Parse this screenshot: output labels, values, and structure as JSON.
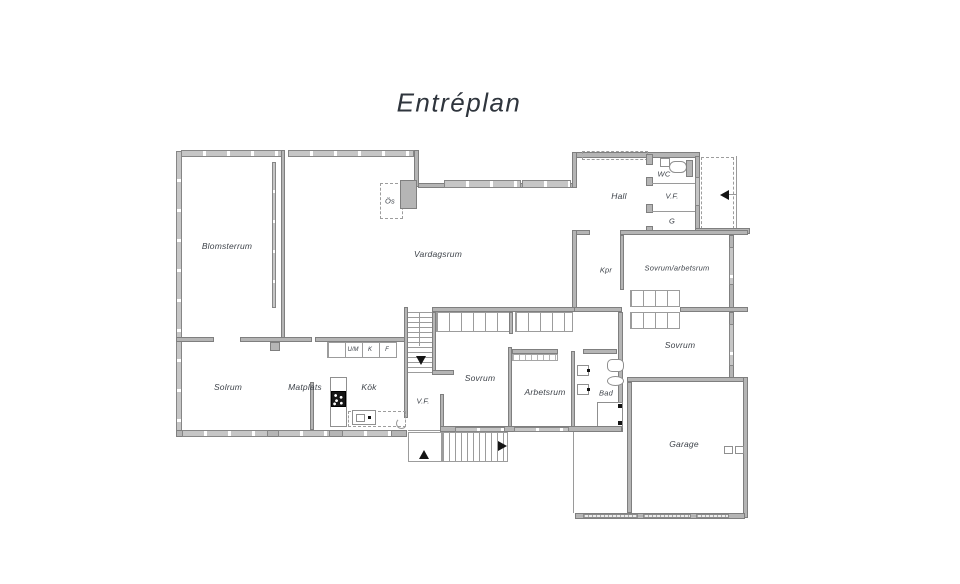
{
  "title": "Entréplan",
  "floorplan": {
    "rooms": {
      "blomsterrum": "Blomsterrum",
      "vardagsrum": "Vardagsrum",
      "os": "Ös",
      "hall": "Hall",
      "wc": "WC",
      "vf_upper": "V.F.",
      "g": "G",
      "kpr": "Kpr",
      "sovrum_arbetsrum": "Sovrum/arbetsrum",
      "sovrum_right": "Sovrum",
      "solrum": "Solrum",
      "matplats": "Matplats",
      "kok": "Kök",
      "vf_lower": "V.F.",
      "sovrum_mid": "Sovrum",
      "arbetsrum": "Arbetsrum",
      "bad": "Bad",
      "garage": "Garage"
    },
    "kitchen_units": {
      "um": "U/M",
      "k": "K",
      "f": "F"
    },
    "colors": {
      "wall": "#b5b5b5",
      "wall_edge": "#7f7f7f",
      "thin_line": "#9c9c9c",
      "text": "#3e434a",
      "arrow": "#141414",
      "background": "#ffffff"
    }
  }
}
